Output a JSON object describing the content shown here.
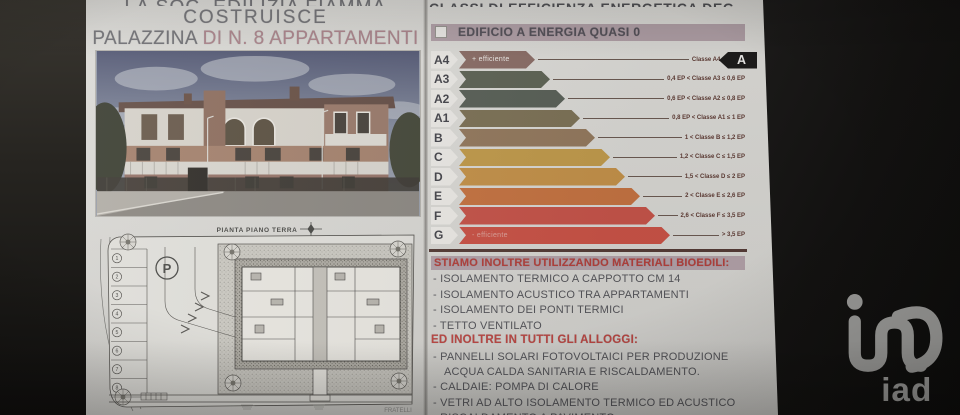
{
  "left_page": {
    "title": {
      "cropped_top_line": "LA SOC. EDILIZIA FIAMMA",
      "line2": "COSTRUISCE",
      "line3_prefix": "PALAZZINA ",
      "line3_accent": "DI N. 8 APPARTAMENTI"
    },
    "plan": {
      "title": "PIANTA PIANO TERRA",
      "parking_symbol": "P",
      "stall_numbers": [
        "1",
        "2",
        "3",
        "4",
        "5",
        "6",
        "7",
        "8"
      ],
      "cropped_bottom_text": "FRATELLI"
    }
  },
  "right_page": {
    "cropped_top_line": "CLASSI DI EFFICIENZA ENERGETICA DEGLI EDIFICI",
    "banner_label": "EDIFICIO A ENERGIA QUASI 0",
    "energy_chart": {
      "more_efficient_label": "+ efficiente",
      "less_efficient_label": "- efficiente",
      "indicator_class": "A",
      "classes": [
        {
          "code": "A4",
          "color": "#8b6e67",
          "range_label": "Classe A4 ≤ 0,4 EP"
        },
        {
          "code": "A3",
          "color": "#5f6456",
          "range_label": "0,4 EP < Classe A3 ≤ 0,6 EP"
        },
        {
          "code": "A2",
          "color": "#5a6158",
          "range_label": "0,6 EP < Classe A2 ≤ 0,8 EP"
        },
        {
          "code": "A1",
          "color": "#7d7257",
          "range_label": "0,8 EP < Classe A1 ≤ 1 EP"
        },
        {
          "code": "B",
          "color": "#93795e",
          "range_label": "1 < Classe B ≤ 1,2 EP"
        },
        {
          "code": "C",
          "color": "#c09a4c",
          "range_label": "1,2 < Classe C ≤ 1,5 EP"
        },
        {
          "code": "D",
          "color": "#c3914a",
          "range_label": "1,5 < Classe D ≤ 2 EP"
        },
        {
          "code": "E",
          "color": "#c47342",
          "range_label": "2 < Classe E ≤ 2,6 EP"
        },
        {
          "code": "F",
          "color": "#c5544a",
          "range_label": "2,6 < Classe F ≤ 3,5 EP"
        },
        {
          "code": "G",
          "color": "#c95347",
          "range_label": "> 3,5 EP"
        }
      ]
    },
    "materials_header": "STIAMO INOLTRE UTILIZZANDO MATERIALI BIOEDILI:",
    "materials": [
      "ISOLAMENTO TERMICO A CAPPOTTO CM 14",
      "ISOLAMENTO ACUSTICO TRA APPARTAMENTI",
      "ISOLAMENTO DEI PONTI TERMICI",
      "TETTO VENTILATO"
    ],
    "units_header": "ED INOLTRE IN TUTTI GLI ALLOGGI:",
    "units_features": [
      "PANNELLI SOLARI FOTOVOLTAICI PER PRODUZIONE ACQUA CALDA SANITARIA E RISCALDAMENTO.",
      "CALDAIE: POMPA DI CALORE",
      "VETRI AD ALTO ISOLAMENTO TERMICO ED ACUSTICO",
      "RISCALDAMENTO A PAVIMENTO"
    ]
  },
  "brand": {
    "logo_text": "iad"
  },
  "colors": {
    "accent_red": "#b4403c",
    "banner_mauve": "#b2a1a8",
    "title_pink": "#ad858c",
    "indicator_bg": "#1d1c1b"
  }
}
